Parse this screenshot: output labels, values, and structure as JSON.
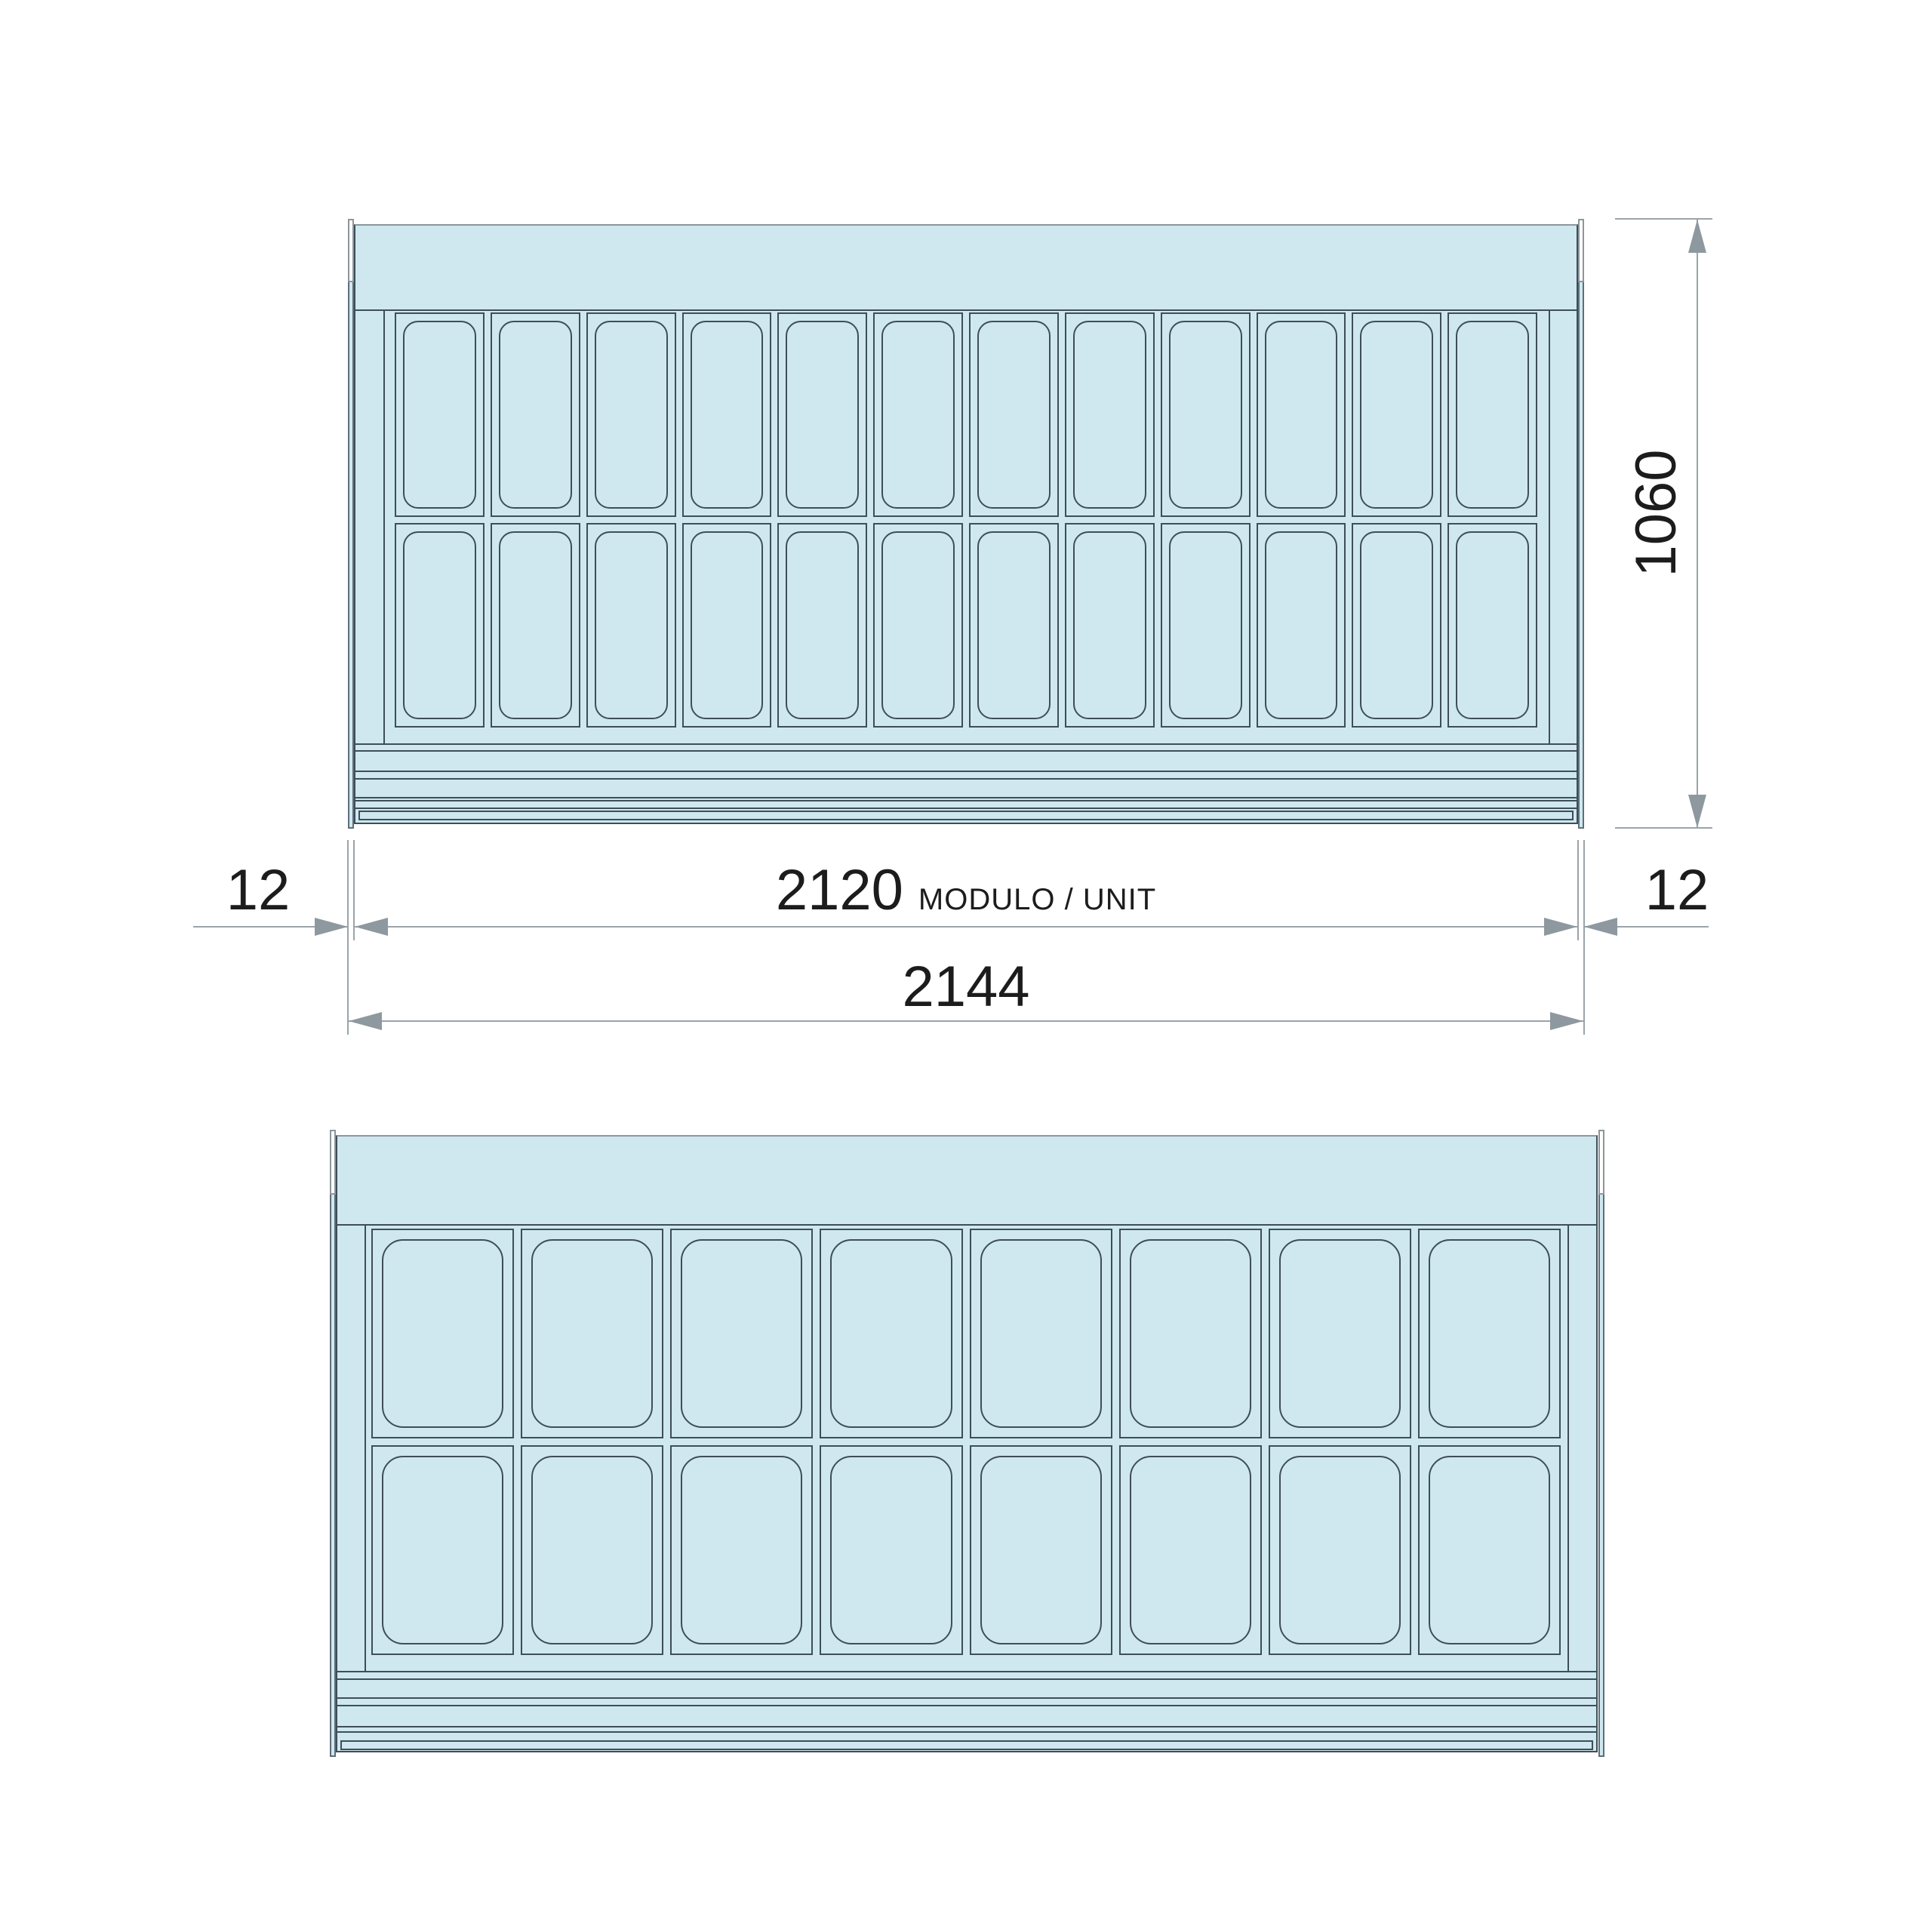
{
  "drawing": {
    "type": "refrigerated-display-case-front-elevations",
    "background": "#ffffff",
    "colors": {
      "body_fill": "#cfe8ef",
      "outline": "#3e4e58",
      "light_outline": "#8b969c",
      "dimension_line": "#9aa4aa",
      "arrow": "#8d989f",
      "text": "#1c1c1c"
    },
    "views": {
      "top": {
        "name": "unit-with-narrow-pans",
        "pan_columns": 12,
        "pan_rows": 2
      },
      "bottom": {
        "name": "unit-with-wide-pans",
        "pan_columns": 8,
        "pan_rows": 2
      }
    },
    "dimensions": {
      "module_width_value": "2120",
      "module_width_suffix": "MODULO / UNIT",
      "overall_width_value": "2144",
      "left_side_value": "12",
      "right_side_value": "12",
      "height_value": "1060"
    }
  }
}
